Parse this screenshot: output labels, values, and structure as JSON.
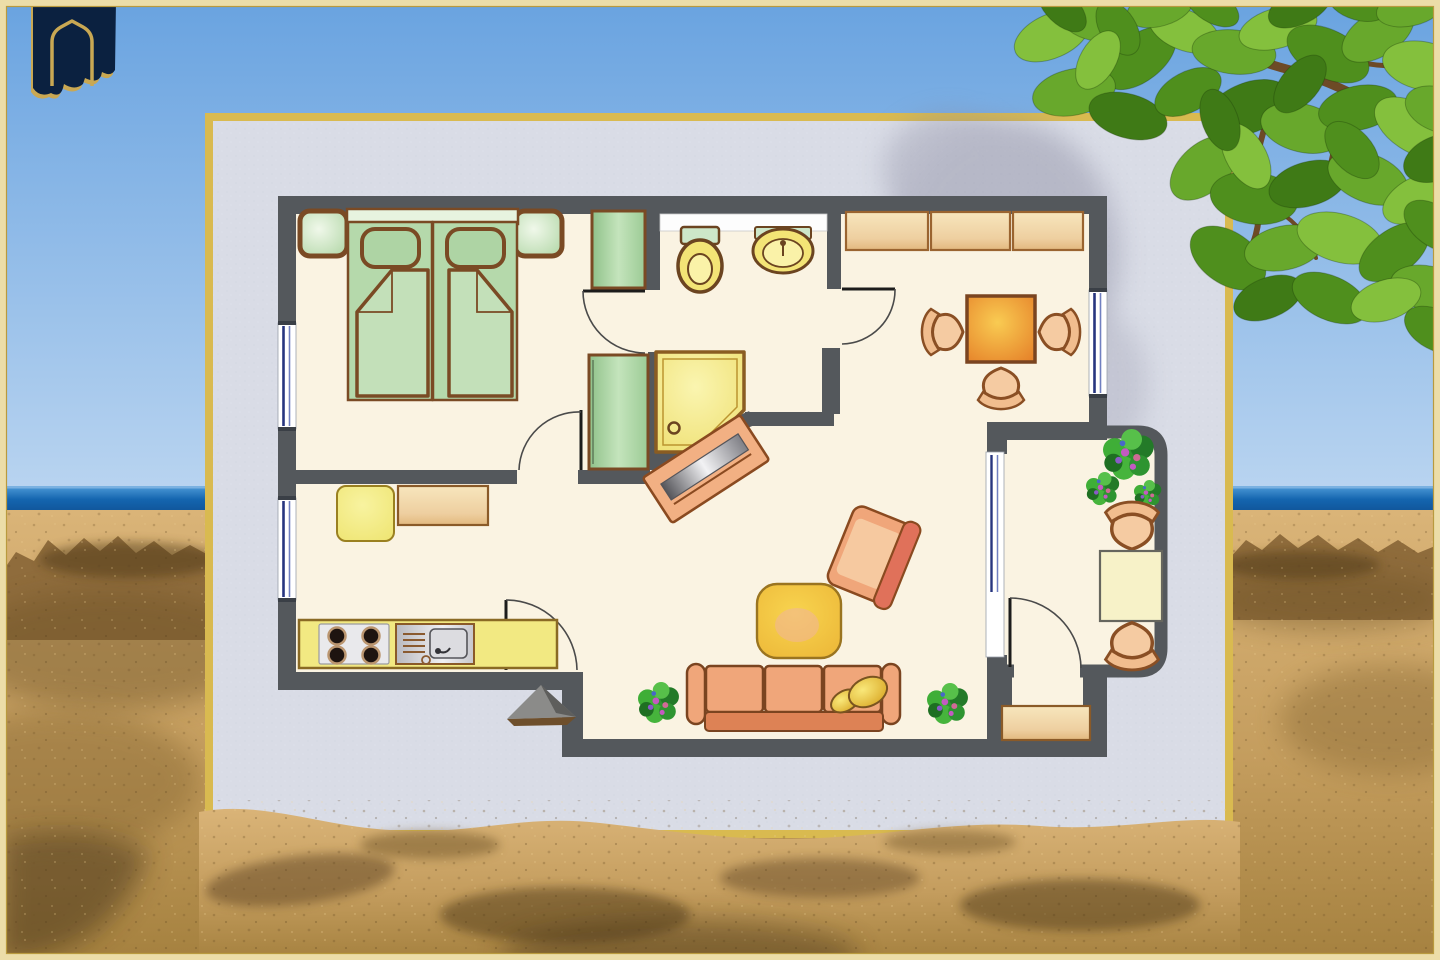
{
  "scene": {
    "description": "Hand-drawn style apartment floor plan on a pale poster board standing on a sandy beach, sea horizon behind, green tree leaves overhanging the top right corner, navy arch emblem top left",
    "width": 1440,
    "height": 960
  },
  "palette": {
    "frame": "#ecdda8",
    "frame_line": "#b99a3e",
    "sky_top": "#69a3e0",
    "sky_horizon": "#b9d4f0",
    "ocean": "#1465af",
    "ocean_deep": "#0f4f92",
    "ocean_light": "#4e9bd8",
    "sand_light": "#dab478",
    "sand": "#c49d5e",
    "sand_deep": "#a5813f",
    "sand_shadow": "#5d4322",
    "rock": "#8f6c3c",
    "poster_bg": "#d9dce6",
    "poster_border": "#d9ba50",
    "wall": "#54585c",
    "floor": "#faf3e2",
    "wood": "#7a4a24",
    "bed_green": "#b5d9ab",
    "bed_blanket": "#c3e0b9",
    "bed_light": "#e7f3df",
    "mint": "#cde7c9",
    "cabinet_green": "#a9d2a2",
    "tan": "#eecfa0",
    "tan_light": "#f7e6bd",
    "yellow": "#f2e982",
    "yellow_deep": "#e3c93c",
    "orange": "#ea9733",
    "orange_light": "#f8c94f",
    "salmon": "#f0a67a",
    "salmon_deep": "#dd8255",
    "armchair_back": "#e0715a",
    "cushion": "#f6c9a0",
    "gold_pillow": "#f0c23c",
    "plant_green": "#2e9431",
    "flower_violet": "#c45ac2",
    "window_navy": "#27357f",
    "glass_white": "#ffffff",
    "tv_steel": "#9a9aa0",
    "logo_navy": "#0b2140",
    "logo_gold": "#c9a853",
    "branch": "#6d4a26",
    "leaf_greens": [
      "#4f8f1d",
      "#68a82c",
      "#84c03d",
      "#3f7a16",
      "#2f5e10"
    ],
    "leaf_shadow": "#83839a"
  },
  "logo": {
    "name": "arch-banner-emblem"
  },
  "floor_plan": {
    "style": "hand-drawn color plan, dark grey walls, cream floors",
    "rooms": [
      {
        "name": "bedroom",
        "furniture": [
          "double-bed",
          "two-pillows",
          "folded-blankets",
          "nightstand-left",
          "nightstand-right",
          "window-left-wall"
        ]
      },
      {
        "name": "closet-nook",
        "furniture": [
          "green-cabinet-top",
          "green-wardrobe"
        ]
      },
      {
        "name": "bathroom",
        "furniture": [
          "white-counter",
          "toilet",
          "washbasin",
          "corner-shower"
        ]
      },
      {
        "name": "dining-room",
        "furniture": [
          "three-wall-cabinets",
          "square-dining-table",
          "three-chairs",
          "window-right-wall",
          "door-arc"
        ]
      },
      {
        "name": "kitchen",
        "furniture": [
          "yellow-side-table",
          "tan-sideboard",
          "counter-with-stove-and-sink",
          "window-left-wall",
          "door-arc"
        ]
      },
      {
        "name": "living-room",
        "furniture": [
          "rotated-tv-sideboard",
          "coffee-table",
          "armchair",
          "three-seat-sofa",
          "two-gold-pillows",
          "plant-left",
          "plant-right",
          "entrance-triangle-mark"
        ]
      },
      {
        "name": "balcony",
        "furniture": [
          "plant-cluster",
          "chair-top",
          "square-table",
          "chair-bottom",
          "glass-wall",
          "door-arc"
        ]
      },
      {
        "name": "storage-alcove",
        "furniture": [
          "tan-cabinet"
        ]
      }
    ]
  },
  "tree": {
    "leaves": [
      [
        1052,
        36,
        40,
        22,
        -24,
        2
      ],
      [
        1096,
        22,
        36,
        19,
        12,
        1
      ],
      [
        1140,
        58,
        42,
        23,
        -38,
        0
      ],
      [
        1184,
        30,
        37,
        20,
        22,
        2
      ],
      [
        1074,
        92,
        42,
        23,
        -12,
        1
      ],
      [
        1128,
        116,
        40,
        22,
        16,
        3
      ],
      [
        1188,
        92,
        36,
        20,
        -28,
        0
      ],
      [
        1234,
        52,
        42,
        22,
        6,
        1
      ],
      [
        1278,
        28,
        40,
        20,
        -16,
        2
      ],
      [
        1328,
        54,
        44,
        24,
        26,
        0
      ],
      [
        1378,
        34,
        40,
        22,
        -32,
        1
      ],
      [
        1424,
        66,
        42,
        24,
        12,
        2
      ],
      [
        1248,
        108,
        44,
        25,
        -22,
        3
      ],
      [
        1302,
        128,
        42,
        24,
        14,
        1
      ],
      [
        1358,
        108,
        40,
        22,
        -12,
        0
      ],
      [
        1414,
        128,
        44,
        24,
        32,
        2
      ],
      [
        1204,
        168,
        40,
        24,
        -42,
        1
      ],
      [
        1254,
        198,
        44,
        26,
        8,
        0
      ],
      [
        1308,
        184,
        40,
        22,
        -16,
        3
      ],
      [
        1368,
        178,
        42,
        24,
        22,
        1
      ],
      [
        1420,
        198,
        40,
        22,
        -26,
        2
      ],
      [
        1228,
        258,
        42,
        26,
        34,
        0
      ],
      [
        1284,
        248,
        40,
        22,
        -12,
        1
      ],
      [
        1340,
        238,
        44,
        24,
        16,
        2
      ],
      [
        1394,
        252,
        40,
        22,
        -36,
        0
      ],
      [
        1428,
        288,
        38,
        22,
        12,
        1
      ],
      [
        1268,
        298,
        36,
        20,
        -22,
        3
      ],
      [
        1330,
        298,
        40,
        22,
        24,
        0
      ],
      [
        1062,
        8,
        30,
        16,
        44,
        3
      ],
      [
        1160,
        8,
        34,
        18,
        -16,
        1
      ],
      [
        1212,
        6,
        30,
        16,
        32,
        0
      ],
      [
        1300,
        6,
        34,
        18,
        -26,
        3
      ],
      [
        1358,
        4,
        30,
        16,
        16,
        0
      ],
      [
        1410,
        8,
        34,
        18,
        -12,
        1
      ],
      [
        1118,
        28,
        30,
        18,
        58,
        0
      ],
      [
        1438,
        158,
        36,
        22,
        -22,
        3
      ],
      [
        1434,
        226,
        34,
        20,
        36,
        0
      ],
      [
        1246,
        156,
        36,
        20,
        60,
        2
      ],
      [
        1300,
        84,
        34,
        19,
        -50,
        3
      ],
      [
        1352,
        150,
        34,
        20,
        48,
        0
      ],
      [
        1098,
        60,
        32,
        18,
        -60,
        2
      ],
      [
        1440,
        110,
        36,
        22,
        20,
        1
      ],
      [
        1220,
        120,
        32,
        18,
        70,
        3
      ],
      [
        1386,
        300,
        36,
        20,
        -18,
        2
      ],
      [
        1436,
        330,
        34,
        20,
        28,
        0
      ]
    ]
  }
}
